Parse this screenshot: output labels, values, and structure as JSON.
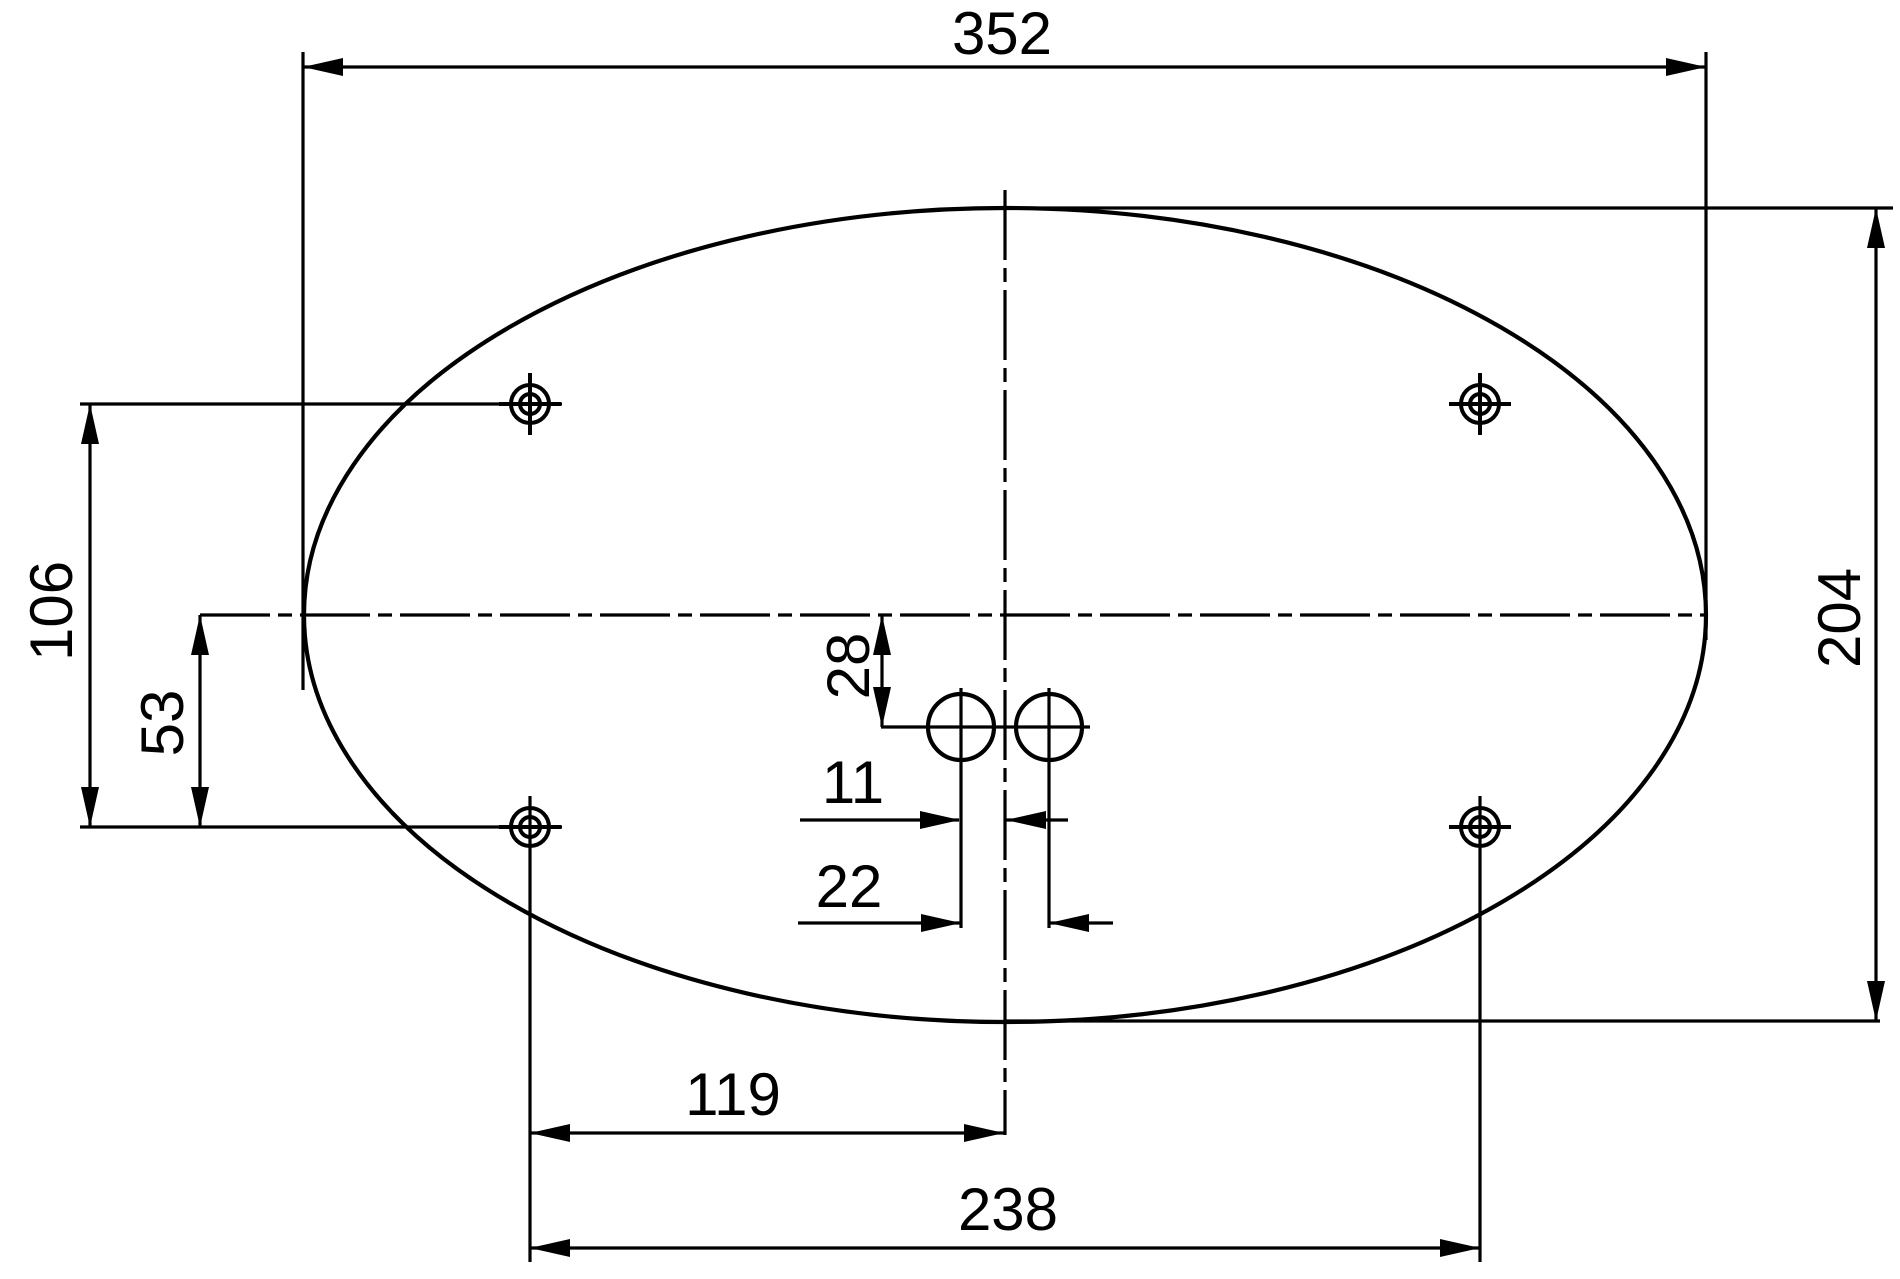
{
  "dims": {
    "width_overall": "352",
    "height_overall": "204",
    "hole_rows_spacing": "106",
    "centerline_to_hole_row": "53",
    "centerline_to_small_holes": "28",
    "small_hole_to_centerline": "11",
    "small_holes_spacing": "22",
    "bottom_hole_to_centerline": "119",
    "bottom_holes_spacing": "238"
  }
}
